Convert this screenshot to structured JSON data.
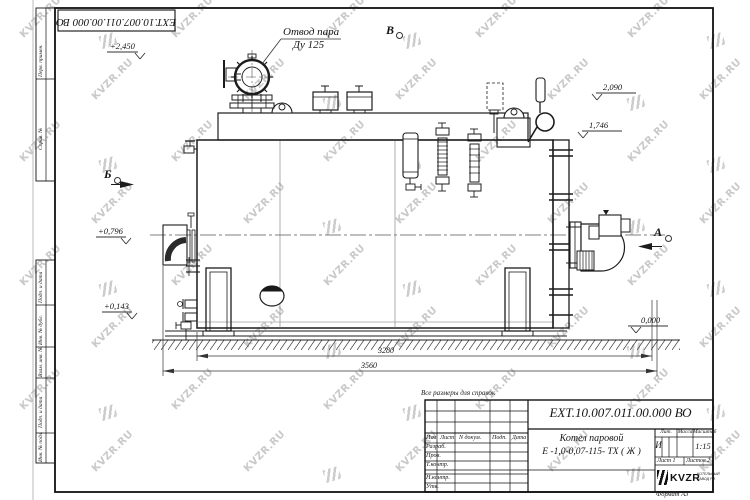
{
  "sheet": {
    "top_stamp": "ЕХТ.10.007.011.00.000  ВО",
    "reference_note": "Все размеры для справок",
    "format_note": "Формат А3",
    "margin_labels": {
      "perv": "Перв. примен.",
      "sprav": "Справ. №",
      "podp1": "Подп. и дата",
      "inv_dubl": "Инв. № дубл.",
      "vzam": "Взам. инв. №",
      "podp2": "Подп. и дата",
      "inv_podl": "Инв. № подл."
    }
  },
  "drawing": {
    "callout": {
      "line1": "Отвод пара",
      "line2": "Ду 125"
    },
    "views": {
      "a": "А",
      "b": "Б",
      "v": "В"
    },
    "elevations": {
      "top": "+2,450",
      "e2090": "2,090",
      "e1746": "1,746",
      "e0796": "+0,796",
      "e0143": "+0,143",
      "zero": "0,000"
    },
    "dimensions": {
      "inner": "3280",
      "outer": "3560"
    }
  },
  "title_block": {
    "doc_number": "ЕХТ.10.007.011.00.000  ВО",
    "product_line1": "Котел паровой",
    "product_line2": "Е -1,0-0,07-115- ТХ ( Ж )",
    "header": {
      "izm": "Изм",
      "list": "Лист",
      "ndoc": "N докум.",
      "podp": "Подп.",
      "data": "Дата"
    },
    "roles": {
      "razrab": "Разраб.",
      "prov": "Пров.",
      "tkontr": "Т.контр.",
      "nkontr": "Н.контр.",
      "utv": "Утв."
    },
    "props": {
      "lit": "Лит.",
      "mass": "Масса",
      "scale": "Масштаб",
      "lit_value": "И",
      "scale_value": "1:15"
    },
    "sheets": {
      "sheet": "Лист 1",
      "total": "Листов 2"
    },
    "logo": {
      "name": "KVZR",
      "sub1": "КОТЕЛЬНЫЙ",
      "sub2": "ЗАВОД РЭ"
    }
  },
  "watermark": {
    "text": "KVZR.RU"
  }
}
